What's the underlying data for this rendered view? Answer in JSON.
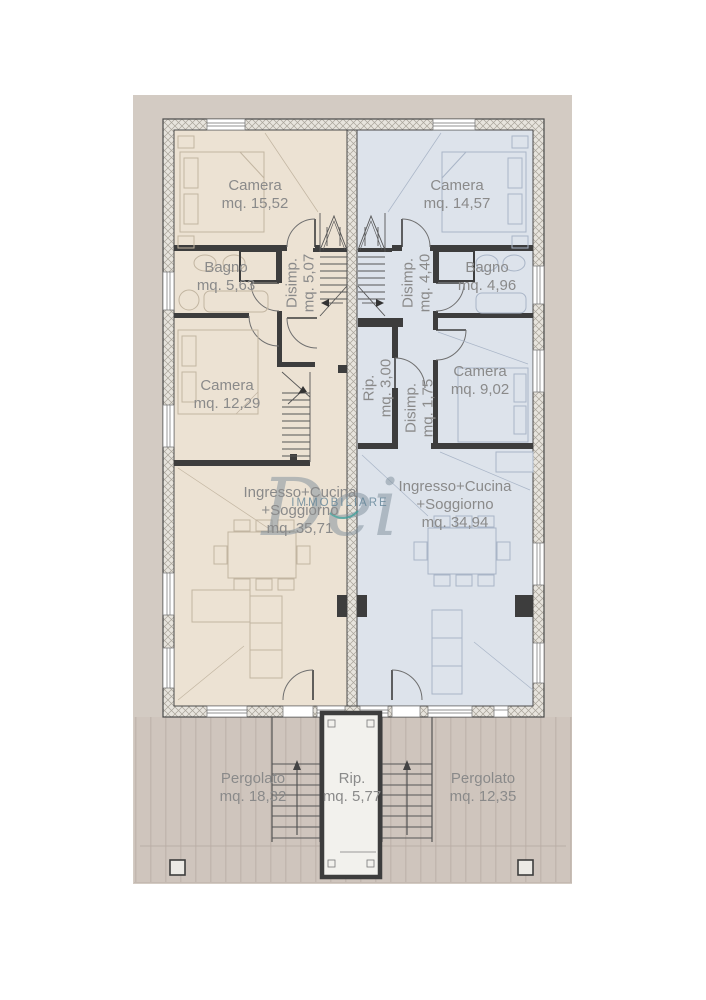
{
  "plan": {
    "watermark": {
      "script": "Dei",
      "caption": "IMMOBILIARE"
    },
    "colors": {
      "left_unit": "#ece2d3",
      "right_unit": "#dde3eb",
      "terrace": "#d3cbc3",
      "deck": "#cfc5bd",
      "wall_dark": "#3d3d3d",
      "label_text": "#8a8a8a"
    },
    "rooms": {
      "camera_tl": {
        "name": "Camera",
        "area": "mq. 15,52"
      },
      "camera_tr": {
        "name": "Camera",
        "area": "mq. 14,57"
      },
      "bagno_l": {
        "name": "Bagno",
        "area": "mq. 5,63"
      },
      "disimp_l": {
        "name": "Disimp.",
        "area": "mq. 5,07"
      },
      "disimp_r": {
        "name": "Disimp.",
        "area": "mq. 4,40"
      },
      "bagno_r": {
        "name": "Bagno",
        "area": "mq. 4,96"
      },
      "camera_ml": {
        "name": "Camera",
        "area": "mq. 12,29"
      },
      "rip_mid": {
        "name": "Rip.",
        "area": "mq. 3,00"
      },
      "disimp_r2": {
        "name": "Disimp.",
        "area": "mq. 1,75"
      },
      "camera_mr": {
        "name": "Camera",
        "area": "mq. 9,02"
      },
      "living_l": {
        "name1": "Ingresso+Cucina",
        "name2": "+Soggiorno",
        "area": "mq. 35,71"
      },
      "living_r": {
        "name1": "Ingresso+Cucina",
        "name2": "+Soggiorno",
        "area": "mq. 34,94"
      },
      "pergolato_l": {
        "name": "Pergolato",
        "area": "mq. 18,32"
      },
      "rip_bottom": {
        "name": "Rip.",
        "area": "mq. 5,77"
      },
      "pergolato_r": {
        "name": "Pergolato",
        "area": "mq. 12,35"
      }
    }
  }
}
